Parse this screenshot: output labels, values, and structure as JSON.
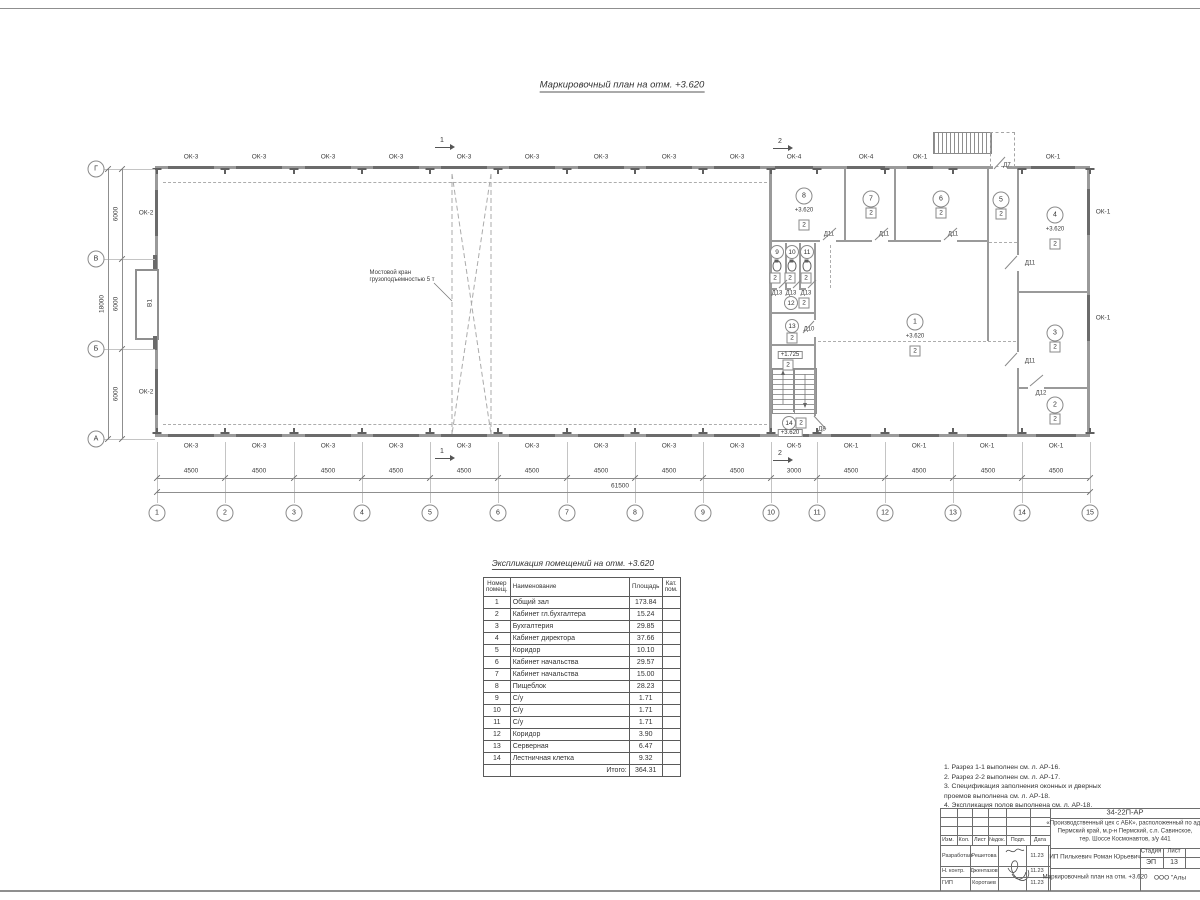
{
  "plan": {
    "title": "Маркировочный план  на отм. +3.620",
    "crane_note": "Мостовой кран\nгрузоподъемностью 5 т",
    "gate_label": "В1",
    "axes_cols": [
      {
        "n": "1",
        "x": 157
      },
      {
        "n": "2",
        "x": 225
      },
      {
        "n": "3",
        "x": 294
      },
      {
        "n": "4",
        "x": 362
      },
      {
        "n": "5",
        "x": 430
      },
      {
        "n": "6",
        "x": 498
      },
      {
        "n": "7",
        "x": 567
      },
      {
        "n": "8",
        "x": 635
      },
      {
        "n": "9",
        "x": 703
      },
      {
        "n": "10",
        "x": 771
      },
      {
        "n": "11",
        "x": 817
      },
      {
        "n": "12",
        "x": 885
      },
      {
        "n": "13",
        "x": 953
      },
      {
        "n": "14",
        "x": 1022
      },
      {
        "n": "15",
        "x": 1090
      }
    ],
    "axes_rows": [
      {
        "n": "Г",
        "y": 169
      },
      {
        "n": "В",
        "y": 259
      },
      {
        "n": "Б",
        "y": 349
      },
      {
        "n": "А",
        "y": 439
      }
    ],
    "bays_bottom": [
      {
        "t": "4500",
        "x": 191
      },
      {
        "t": "4500",
        "x": 259
      },
      {
        "t": "4500",
        "x": 328
      },
      {
        "t": "4500",
        "x": 396
      },
      {
        "t": "4500",
        "x": 464
      },
      {
        "t": "4500",
        "x": 532
      },
      {
        "t": "4500",
        "x": 601
      },
      {
        "t": "4500",
        "x": 669
      },
      {
        "t": "4500",
        "x": 737
      },
      {
        "t": "3000",
        "x": 794
      },
      {
        "t": "4500",
        "x": 851
      },
      {
        "t": "4500",
        "x": 919
      },
      {
        "t": "4500",
        "x": 988
      },
      {
        "t": "4500",
        "x": 1056
      }
    ],
    "total_bottom": "61500",
    "bays_left": [
      {
        "t": "6000",
        "y": 214
      },
      {
        "t": "6000",
        "y": 304
      },
      {
        "t": "6000",
        "y": 394
      }
    ],
    "total_left": "18000",
    "windows_top": [
      {
        "t": "ОК-3",
        "x": 191,
        "w": 46
      },
      {
        "t": "ОК-3",
        "x": 259,
        "w": 46
      },
      {
        "t": "ОК-3",
        "x": 328,
        "w": 46
      },
      {
        "t": "ОК-3",
        "x": 396,
        "w": 46
      },
      {
        "t": "ОК-3",
        "x": 464,
        "w": 46
      },
      {
        "t": "ОК-3",
        "x": 532,
        "w": 46
      },
      {
        "t": "ОК-3",
        "x": 601,
        "w": 46
      },
      {
        "t": "ОК-3",
        "x": 669,
        "w": 46
      },
      {
        "t": "ОК-3",
        "x": 737,
        "w": 46
      },
      {
        "t": "ОК-4",
        "x": 794,
        "w": 38
      },
      {
        "t": "ОК-4",
        "x": 866,
        "w": 38
      },
      {
        "t": "ОК-1",
        "x": 920,
        "w": 26
      },
      {
        "t": "ОК-1",
        "x": 1053,
        "w": 44
      }
    ],
    "windows_bottom": [
      {
        "t": "ОК-3",
        "x": 191,
        "w": 46
      },
      {
        "t": "ОК-3",
        "x": 259,
        "w": 46
      },
      {
        "t": "ОК-3",
        "x": 328,
        "w": 46
      },
      {
        "t": "ОК-3",
        "x": 396,
        "w": 46
      },
      {
        "t": "ОК-3",
        "x": 464,
        "w": 46
      },
      {
        "t": "ОК-3",
        "x": 532,
        "w": 46
      },
      {
        "t": "ОК-3",
        "x": 601,
        "w": 46
      },
      {
        "t": "ОК-3",
        "x": 669,
        "w": 46
      },
      {
        "t": "ОК-3",
        "x": 737,
        "w": 46
      },
      {
        "t": "ОК-5",
        "x": 794,
        "w": 30
      },
      {
        "t": "ОК-1",
        "x": 851,
        "w": 40
      },
      {
        "t": "ОК-1",
        "x": 919,
        "w": 40
      },
      {
        "t": "ОК-1",
        "x": 987,
        "w": 40
      },
      {
        "t": "ОК-1",
        "x": 1056,
        "w": 40
      }
    ],
    "windows_left": [
      {
        "t": "ОК-2",
        "y": 213
      },
      {
        "t": "ОК-2",
        "y": 392
      }
    ],
    "windows_right": [
      {
        "t": "ОК-1",
        "y": 212
      },
      {
        "t": "ОК-1",
        "y": 318
      }
    ],
    "rooms": [
      {
        "n": "1",
        "x": 915,
        "y": 322,
        "elev": "+3.620",
        "ex": 915,
        "ey": 337,
        "cat": "2",
        "cx": 915,
        "cy": 351
      },
      {
        "n": "2",
        "x": 1055,
        "y": 405,
        "cat": "2",
        "cx": 1055,
        "cy": 419
      },
      {
        "n": "3",
        "x": 1055,
        "y": 333,
        "cat": "2",
        "cx": 1055,
        "cy": 347
      },
      {
        "n": "4",
        "x": 1055,
        "y": 215,
        "elev": "+3.620",
        "ex": 1055,
        "ey": 230,
        "cat": "2",
        "cx": 1055,
        "cy": 244
      },
      {
        "n": "5",
        "x": 1001,
        "y": 200,
        "cat": "2",
        "cx": 1001,
        "cy": 214
      },
      {
        "n": "6",
        "x": 941,
        "y": 199,
        "cat": "2",
        "cx": 941,
        "cy": 213
      },
      {
        "n": "7",
        "x": 871,
        "y": 199,
        "cat": "2",
        "cx": 871,
        "cy": 213
      },
      {
        "n": "8",
        "x": 804,
        "y": 196,
        "elev": "+3.620",
        "ex": 804,
        "ey": 211,
        "cat": "2",
        "cx": 804,
        "cy": 225
      },
      {
        "n": "9",
        "x": 777,
        "y": 252,
        "small": true,
        "cat": "2",
        "cx": 775,
        "cy": 278
      },
      {
        "n": "10",
        "x": 792,
        "y": 252,
        "small": true,
        "cat": "2",
        "cx": 790,
        "cy": 278
      },
      {
        "n": "11",
        "x": 807,
        "y": 252,
        "small": true,
        "cat": "2",
        "cx": 806,
        "cy": 278
      },
      {
        "n": "12",
        "x": 791,
        "y": 303,
        "small": true,
        "cat": "2",
        "cx": 804,
        "cy": 303
      },
      {
        "n": "13",
        "x": 792,
        "y": 326,
        "small": true,
        "cat": "2",
        "cx": 792,
        "cy": 338
      },
      {
        "n": "14",
        "x": 789,
        "y": 423,
        "small": true,
        "cat": "2",
        "cx": 801,
        "cy": 423
      }
    ],
    "wc_x": [
      777,
      792,
      807
    ],
    "wc_y": 266,
    "elev_boxes": [
      {
        "t": "+1.725",
        "x": 790,
        "y": 355,
        "cat": "2",
        "cx": 788,
        "cy": 365
      },
      {
        "t": "+3.620",
        "x": 790,
        "y": 433
      }
    ],
    "doors": [
      {
        "t": "Д11",
        "x": 829,
        "y": 235
      },
      {
        "t": "Д11",
        "x": 884,
        "y": 235
      },
      {
        "t": "Д11",
        "x": 953,
        "y": 235
      },
      {
        "t": "Д11",
        "x": 1030,
        "y": 264
      },
      {
        "t": "Д11",
        "x": 1030,
        "y": 362
      },
      {
        "t": "Д12",
        "x": 1041,
        "y": 394
      },
      {
        "t": "Д10",
        "x": 809,
        "y": 330
      },
      {
        "t": "Д8",
        "x": 822,
        "y": 430
      },
      {
        "t": "Д7",
        "x": 1007,
        "y": 166
      },
      {
        "t": "Д13",
        "x": 777,
        "y": 294
      },
      {
        "t": "Д13",
        "x": 791,
        "y": 294
      },
      {
        "t": "Д13",
        "x": 806,
        "y": 294
      }
    ],
    "sections": [
      {
        "n": "1",
        "x": 445,
        "y": 141
      },
      {
        "n": "2",
        "x": 783,
        "y": 142
      },
      {
        "n": "1",
        "x": 445,
        "y": 452
      },
      {
        "n": "2",
        "x": 783,
        "y": 454
      }
    ]
  },
  "explication": {
    "title": "Экспликация помещений на отм. +3.620",
    "headers": [
      "Номер\nпомещ.",
      "Наименование",
      "Площадь",
      "Кат.\nпом."
    ],
    "rows": [
      [
        "1",
        "Общий зал",
        "173.84"
      ],
      [
        "2",
        "Кабинет гл.бухгалтера",
        "15.24"
      ],
      [
        "3",
        "Бухгалтерия",
        "29.85"
      ],
      [
        "4",
        "Кабинет директора",
        "37.66"
      ],
      [
        "5",
        "Коридор",
        "10.10"
      ],
      [
        "6",
        "Кабинет начальства",
        "29.57"
      ],
      [
        "7",
        "Кабинет начальства",
        "15.00"
      ],
      [
        "8",
        "Пищеблок",
        "28.23"
      ],
      [
        "9",
        "С/у",
        "1.71"
      ],
      [
        "10",
        "С/у",
        "1.71"
      ],
      [
        "11",
        "С/у",
        "1.71"
      ],
      [
        "12",
        "Коридор",
        "3.90"
      ],
      [
        "13",
        "Серверная",
        "6.47"
      ],
      [
        "14",
        "Лестничная клетка",
        "9.32"
      ]
    ],
    "total_label": "Итого:",
    "total": "364.31"
  },
  "notes": [
    "1. Разрез 1-1 выполнен см. л. АР-16.",
    "2. Разрез 2-2 выполнен см. л. АР-17.",
    "3. Спецификация заполнения оконных и дверных\n    проемов выполнена см. л. АР-18.",
    "4. Экспликация полов выполнена см. л. АР-18."
  ],
  "stamp": {
    "doc_number": "34-22П-АР",
    "project_lines": [
      "«Производственный цех с АБК», расположенный по адр",
      "Пермский край, м.р-н Пермский, с.п. Савинское,",
      "тер. Шоссе Космонавтов, з/у 441"
    ],
    "cols": [
      "Изм.",
      "Кол.",
      "Лист",
      "№док.",
      "Подп.",
      "Дата"
    ],
    "rows": [
      {
        "role": "Разработал",
        "name": "Решетова",
        "date": "11.23"
      },
      {
        "role": "Н. контр.",
        "name": "Джентазов",
        "date": "11.23"
      },
      {
        "role": "ГИП",
        "name": "Коротаев",
        "date": "11.23"
      }
    ],
    "client": "ИП Пилькевич Роман Юрьевич",
    "stage_label": "Стадия",
    "sheet_label": "Лист",
    "stage": "ЭП",
    "sheet": "13",
    "sheet_title": "Маркировочный план на отм. +3.620",
    "org": "ООО \"Алы"
  }
}
